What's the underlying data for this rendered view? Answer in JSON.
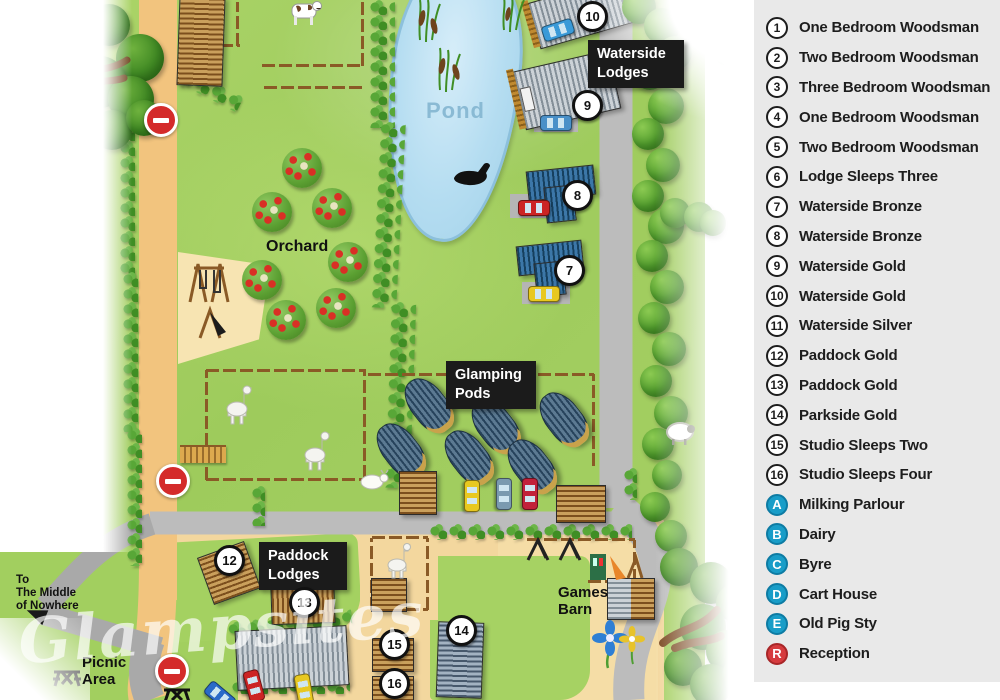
{
  "colors": {
    "panel_bg": "#e9e9e9",
    "letter_bg": "#189dc8",
    "reception_bg": "#d63b3e",
    "road_tan": "#f2c47e",
    "road_gray": "#bcbcbc",
    "pond_blue": "#b5ddf1",
    "label_box": "#1b1b1b"
  },
  "legend": {
    "items": [
      {
        "id": "1",
        "label": "One Bedroom Woodsman",
        "type": "number"
      },
      {
        "id": "2",
        "label": "Two Bedroom Woodsman",
        "type": "number"
      },
      {
        "id": "3",
        "label": "Three Bedroom Woodsman",
        "type": "number"
      },
      {
        "id": "4",
        "label": "One Bedroom Woodsman",
        "type": "number"
      },
      {
        "id": "5",
        "label": "Two Bedroom Woodsman",
        "type": "number"
      },
      {
        "id": "6",
        "label": "Lodge Sleeps Three",
        "type": "number"
      },
      {
        "id": "7",
        "label": "Waterside Bronze",
        "type": "number"
      },
      {
        "id": "8",
        "label": "Waterside Bronze",
        "type": "number"
      },
      {
        "id": "9",
        "label": "Waterside Gold",
        "type": "number"
      },
      {
        "id": "10",
        "label": "Waterside Gold",
        "type": "number"
      },
      {
        "id": "11",
        "label": "Waterside Silver",
        "type": "number"
      },
      {
        "id": "12",
        "label": "Paddock Gold",
        "type": "number"
      },
      {
        "id": "13",
        "label": "Paddock Gold",
        "type": "number"
      },
      {
        "id": "14",
        "label": "Parkside Gold",
        "type": "number"
      },
      {
        "id": "15",
        "label": "Studio Sleeps Two",
        "type": "number"
      },
      {
        "id": "16",
        "label": "Studio Sleeps Four",
        "type": "number"
      },
      {
        "id": "A",
        "label": "Milking Parlour",
        "type": "letter"
      },
      {
        "id": "B",
        "label": "Dairy",
        "type": "letter"
      },
      {
        "id": "C",
        "label": "Byre",
        "type": "letter"
      },
      {
        "id": "D",
        "label": "Cart House",
        "type": "letter"
      },
      {
        "id": "E",
        "label": "Old Pig Sty",
        "type": "letter"
      },
      {
        "id": "R",
        "label": "Reception",
        "type": "reception"
      }
    ]
  },
  "map": {
    "labels": {
      "pond": "Pond",
      "orchard": "Orchard",
      "waterside_lodges": "Waterside\nLodges",
      "glamping_pods": "Glamping\nPods",
      "paddock_lodges": "Paddock\nLodges",
      "games_barn": "Games\nBarn",
      "picnic_area": "Picnic\nArea",
      "to_nowhere": "To\nThe Middle\nof Nowhere",
      "watermark": "Glampsites"
    },
    "markers": [
      {
        "id": "10",
        "x": 590,
        "y": 14
      },
      {
        "id": "9",
        "x": 585,
        "y": 103
      },
      {
        "id": "8",
        "x": 575,
        "y": 193
      },
      {
        "id": "7",
        "x": 567,
        "y": 268
      },
      {
        "id": "12",
        "x": 227,
        "y": 558
      },
      {
        "id": "13",
        "x": 302,
        "y": 600
      },
      {
        "id": "15",
        "x": 392,
        "y": 642
      },
      {
        "id": "16",
        "x": 392,
        "y": 681
      },
      {
        "id": "14",
        "x": 459,
        "y": 628
      }
    ]
  }
}
